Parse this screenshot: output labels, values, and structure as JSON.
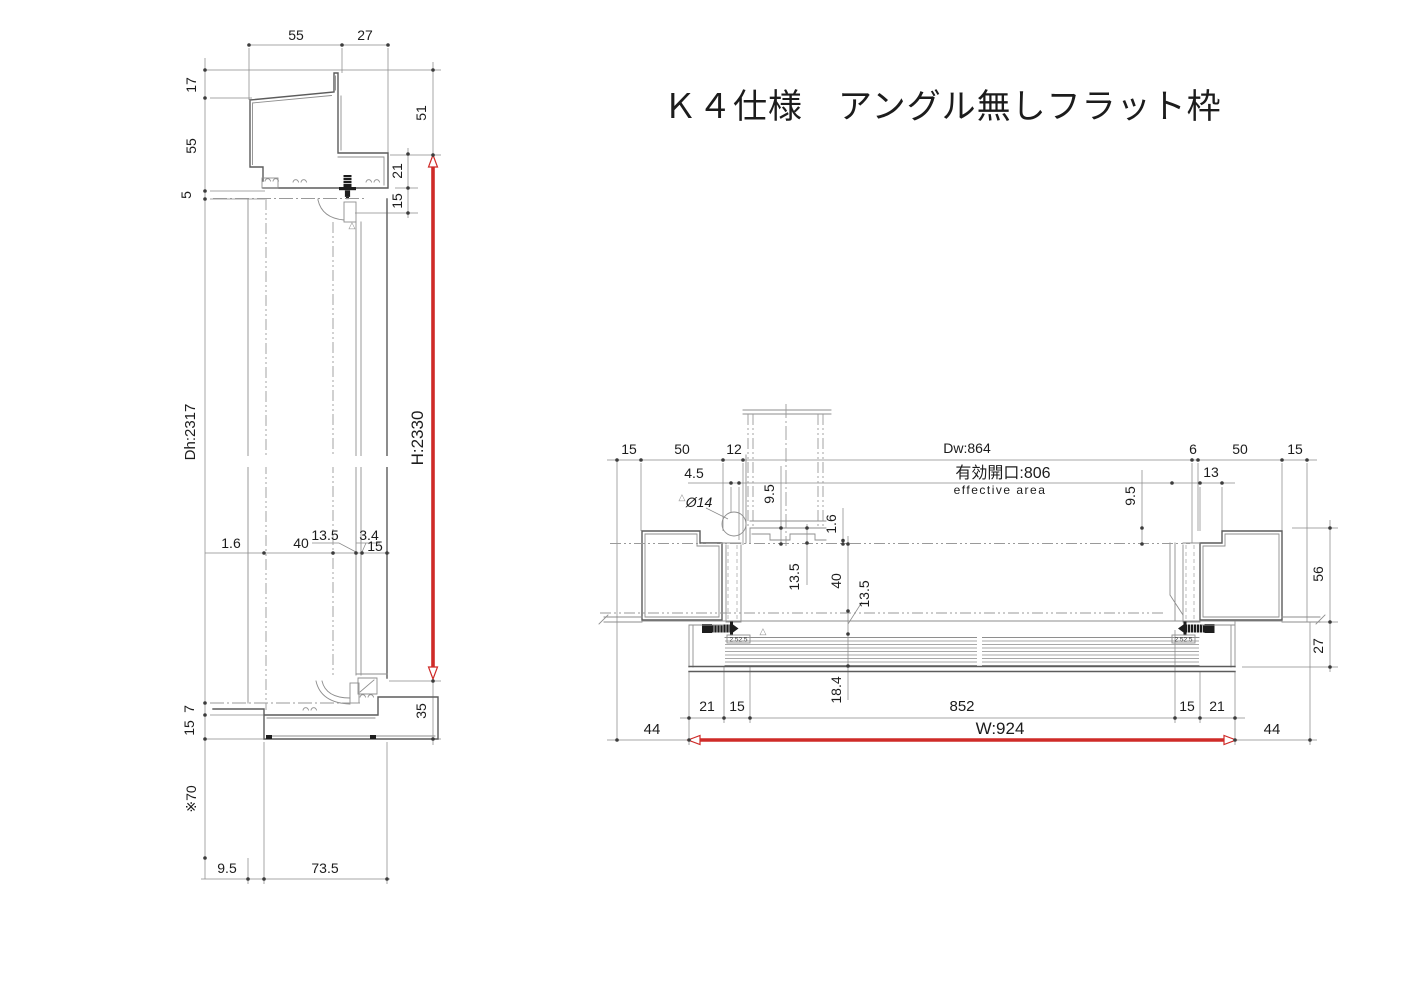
{
  "title": {
    "text": "Ｋ４仕様　アングル無しフラット枠"
  },
  "colors": {
    "accent_red": "#cf2b28",
    "line_dark": "#5c5c5c",
    "line_mid": "#8e8e8e",
    "text": "#1c1c1c"
  },
  "marks": {
    "triangle": "△"
  },
  "vertical_section": {
    "top_dims": {
      "w55": "55",
      "w27": "27"
    },
    "left_dims": {
      "d17": "17",
      "d55": "55",
      "d5": "5",
      "door_height": "Dh:2317",
      "d7": "7",
      "d15": "15",
      "d70": "※70"
    },
    "mid_dims": {
      "d1_6": "1.6",
      "d40": "40",
      "d13_5": "13.5",
      "d3_4": "3.4",
      "d15": "15"
    },
    "right_dims": {
      "d51": "51",
      "d21": "21",
      "d15": "15",
      "frame_height": "H:2330",
      "d35": "35"
    },
    "bottom_dims": {
      "d9_5": "9.5",
      "d73_5": "73.5"
    }
  },
  "horizontal_section": {
    "top_dims": {
      "d15_l": "15",
      "d50_l": "50",
      "d12": "12",
      "door_width": "Dw:864",
      "opening": "有効開口:806",
      "opening_en": "effective area",
      "d6": "6",
      "d50_r": "50",
      "d15_r": "15"
    },
    "detail_dims": {
      "d4_5": "4.5",
      "phi14": "Ø14",
      "d9_5_l": "9.5",
      "d1_6": "1.6",
      "d13_5_l": "13.5",
      "d40": "40",
      "d13_5_r": "13.5",
      "d18_4": "18.4",
      "d13": "13",
      "d9_5_r": "9.5"
    },
    "right_dims": {
      "d56": "56",
      "d27": "27"
    },
    "bottom_dims": {
      "d21_l": "21",
      "d15_l": "15",
      "d852": "852",
      "d15_r": "15",
      "d21_r": "21",
      "d44_l": "44",
      "frame_width": "W:924",
      "d44_r": "44"
    },
    "labels": {
      "screw_l": "2.52.5",
      "screw_r": "2.52.5"
    }
  }
}
